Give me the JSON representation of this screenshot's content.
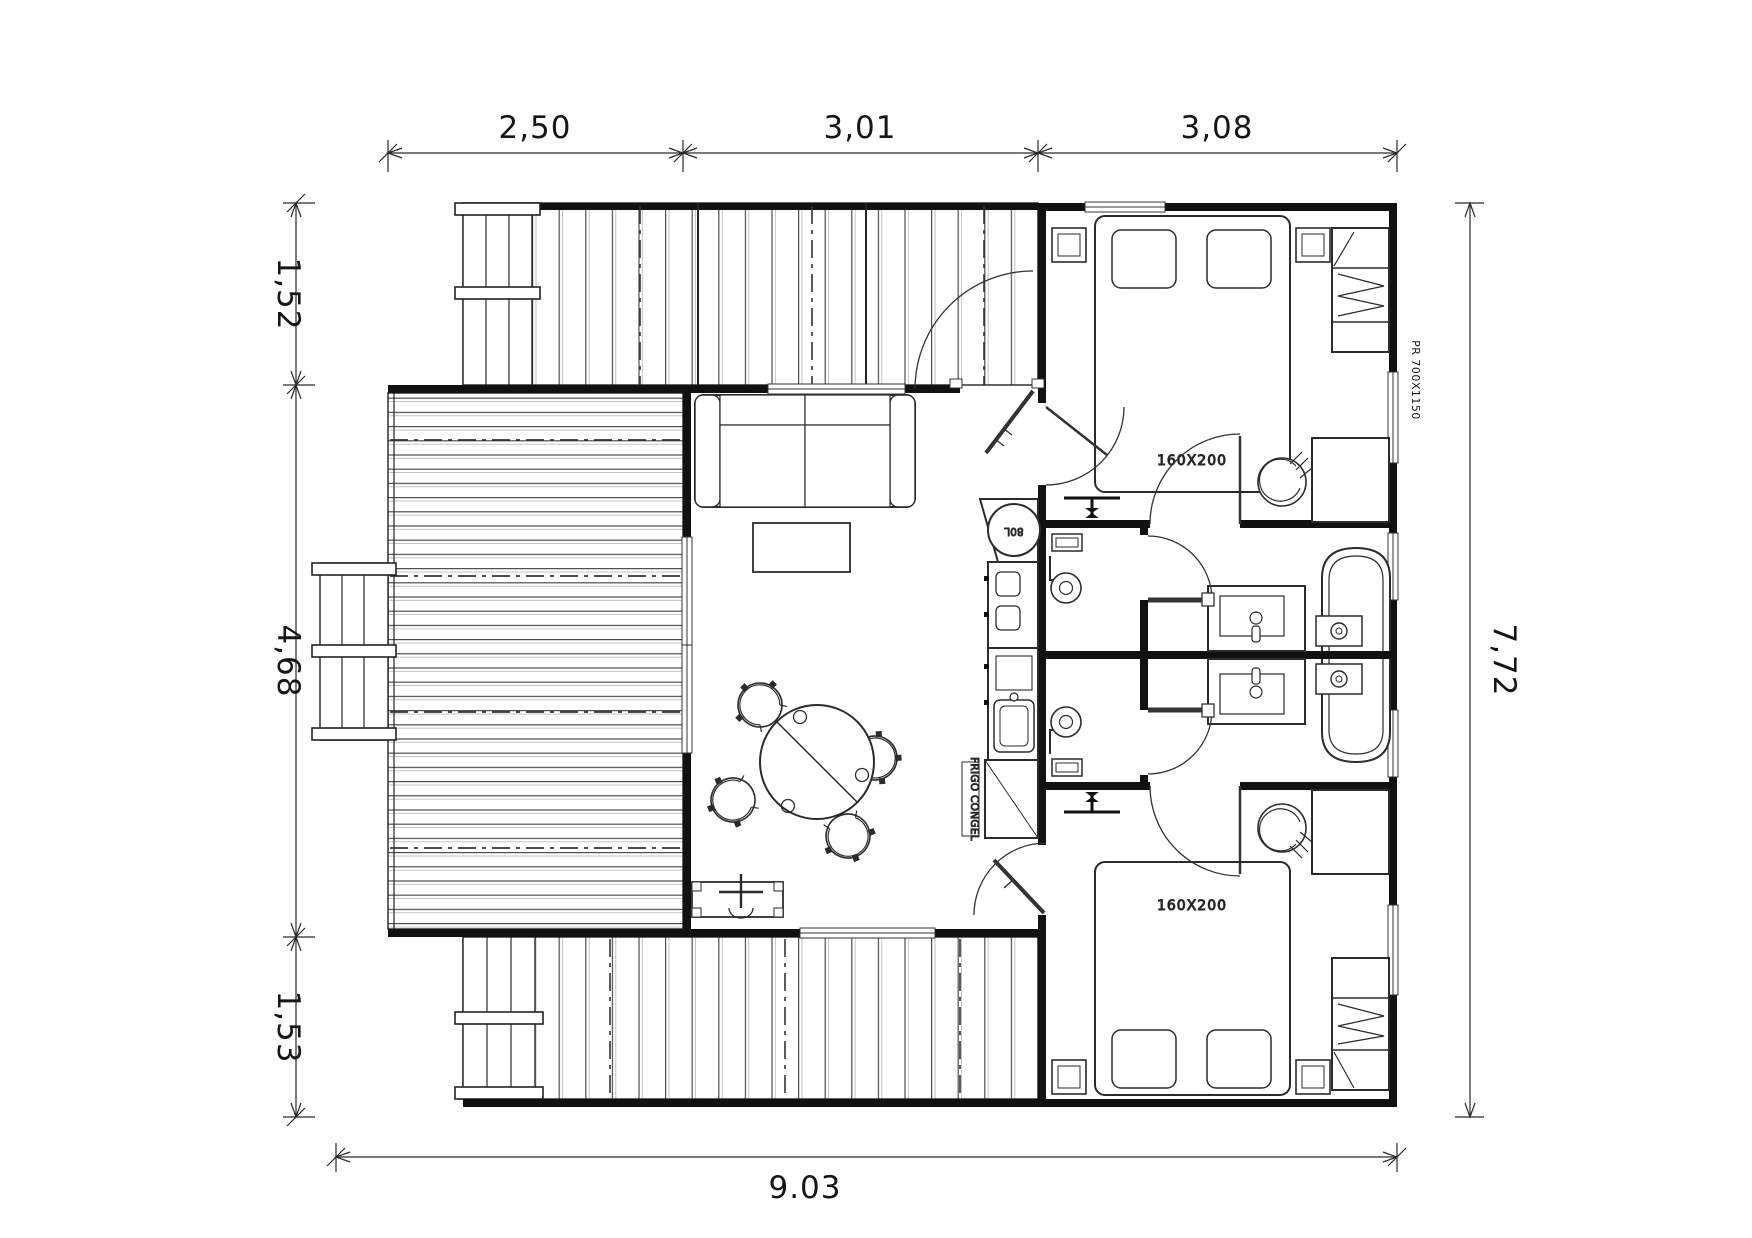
{
  "drawing": {
    "title": "cabin-floor-plan",
    "colors": {
      "ink": "#161616",
      "wall": "#111111",
      "paper": "#ffffff"
    },
    "dimensions": {
      "top": [
        "2,50",
        "3,01",
        "3,08"
      ],
      "left": [
        "1,52",
        "4,68",
        "1,53"
      ],
      "right": "7,72",
      "bottom": "9.03"
    },
    "labels": {
      "bed1": "160X200",
      "bed2": "160X200",
      "window_right": "PR 700X1150",
      "fridge": "FRIGO CONGEL",
      "water_heater": "80L"
    }
  }
}
